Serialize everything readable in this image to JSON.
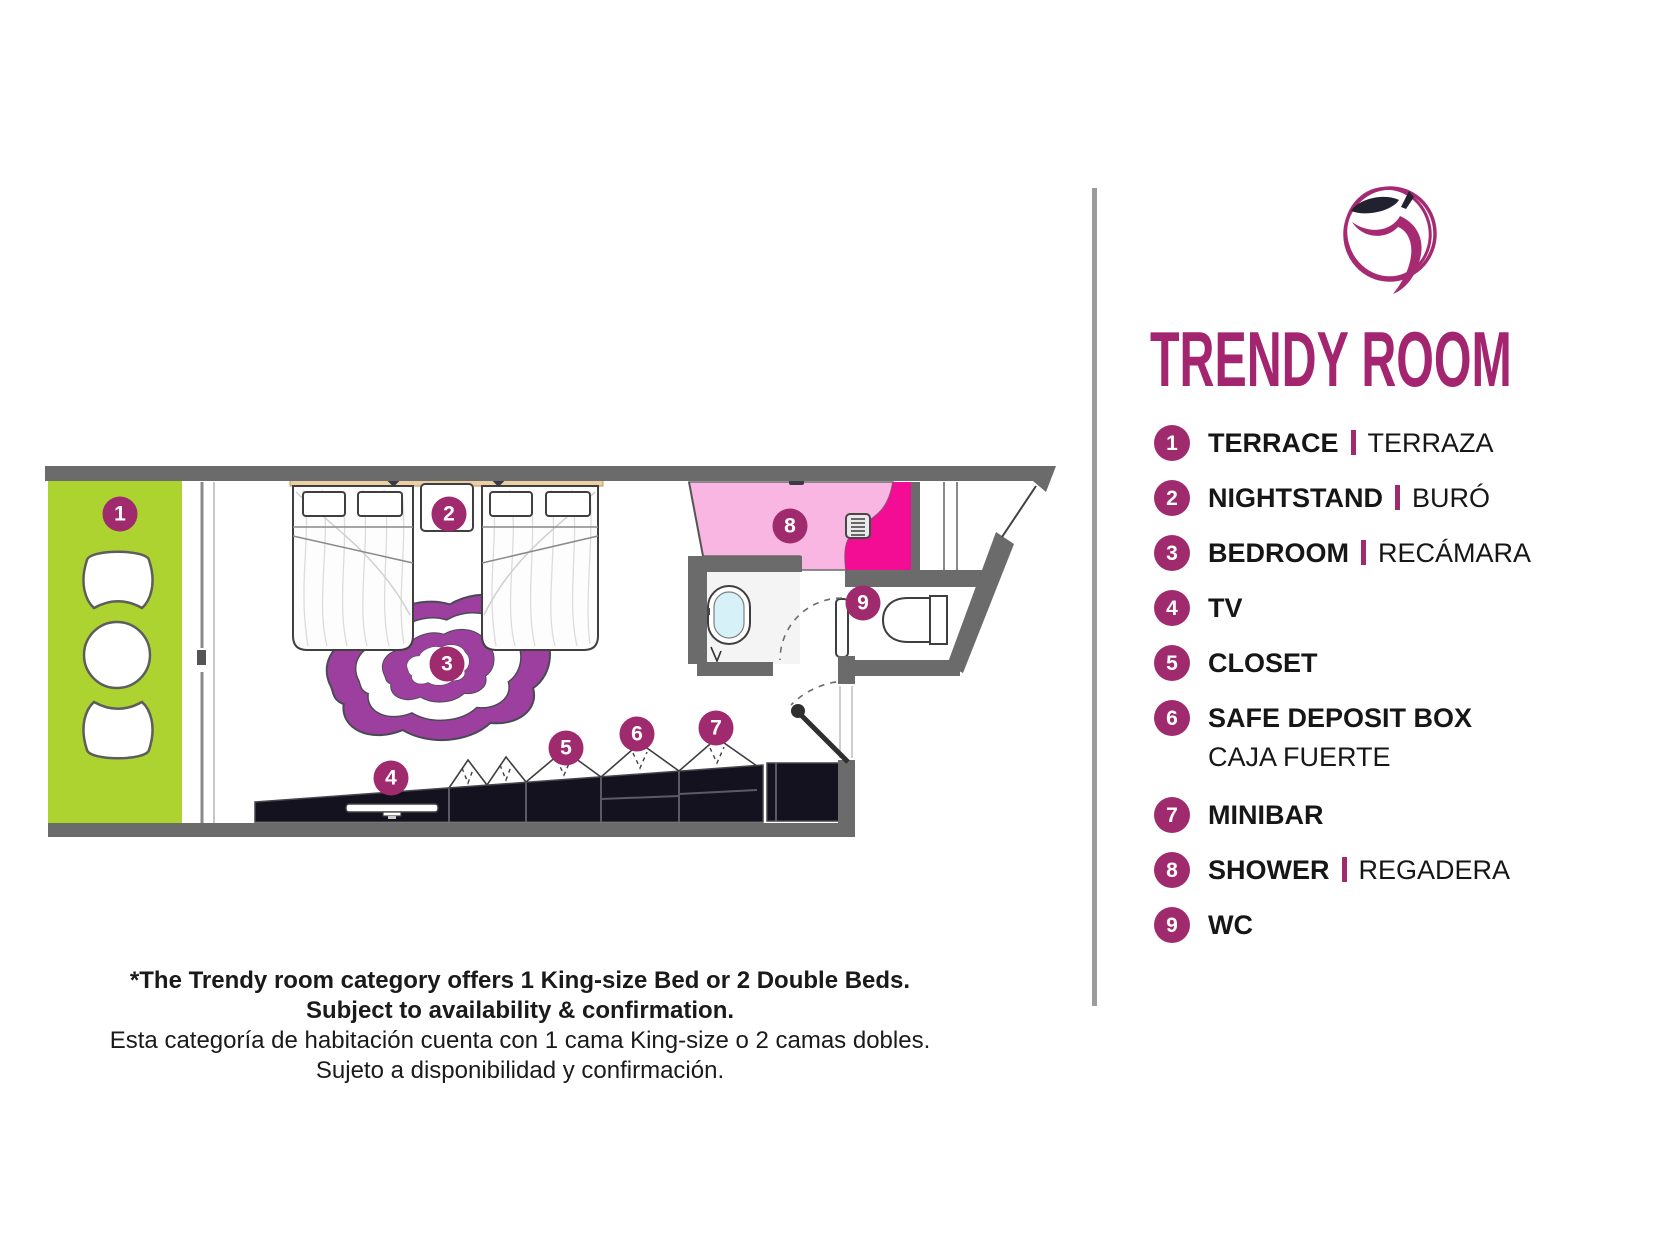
{
  "brand": {
    "primary_color": "#a02a6e",
    "title_color": "#a3256f",
    "rug_purple": "#9d3f9f",
    "terrace_green": "#acd32f",
    "shower_pink_light": "#f9b6e2",
    "shower_pink_hot": "#f30d94",
    "wall_gray": "#6b6b6b",
    "console_dark": "#15121f"
  },
  "header": {
    "logo": "apple-scribble-logo",
    "title": "TRENDY ROOM"
  },
  "legend": {
    "items": [
      {
        "num": "1",
        "en": "TERRACE",
        "es": "TERRAZA",
        "stacked": false
      },
      {
        "num": "2",
        "en": "NIGHTSTAND",
        "es": "BURÓ",
        "stacked": false
      },
      {
        "num": "3",
        "en": "BEDROOM",
        "es": "RECÁMARA",
        "stacked": false
      },
      {
        "num": "4",
        "en": "TV",
        "es": "",
        "stacked": false
      },
      {
        "num": "5",
        "en": "CLOSET",
        "es": "",
        "stacked": false
      },
      {
        "num": "6",
        "en": "SAFE DEPOSIT BOX",
        "es": "CAJA FUERTE",
        "stacked": true
      },
      {
        "num": "7",
        "en": "MINIBAR",
        "es": "",
        "stacked": false
      },
      {
        "num": "8",
        "en": "SHOWER",
        "es": "REGADERA",
        "stacked": false
      },
      {
        "num": "9",
        "en": "WC",
        "es": "",
        "stacked": false
      }
    ]
  },
  "plan": {
    "markers": [
      {
        "num": "1",
        "x": 120,
        "y": 514
      },
      {
        "num": "2",
        "x": 449,
        "y": 514
      },
      {
        "num": "3",
        "x": 447,
        "y": 664
      },
      {
        "num": "4",
        "x": 391,
        "y": 778
      },
      {
        "num": "5",
        "x": 566,
        "y": 748
      },
      {
        "num": "6",
        "x": 637,
        "y": 734
      },
      {
        "num": "7",
        "x": 716,
        "y": 728
      },
      {
        "num": "8",
        "x": 790,
        "y": 526
      },
      {
        "num": "9",
        "x": 863,
        "y": 603
      }
    ]
  },
  "footnote": {
    "bold_lines": [
      "*The Trendy room category offers 1 King-size Bed or 2 Double Beds.",
      "Subject to availability & confirmation."
    ],
    "regular_lines": [
      "Esta categoría de habitación cuenta con 1 cama King-size o 2 camas dobles.",
      "Sujeto a disponibilidad y confirmación."
    ]
  }
}
